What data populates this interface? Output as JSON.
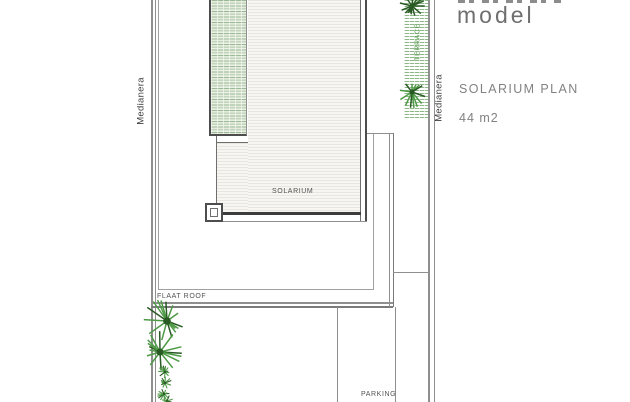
{
  "panel": {
    "model_label": "model",
    "plan_title": "SOLARIUM PLAN",
    "area_label": "44 m2"
  },
  "plan": {
    "labels": {
      "left_boundary": "Medianera",
      "right_boundary": "Medianera",
      "terrace": "TERRACE",
      "solarium": "SOLARIUM",
      "flat_roof": "FLAAT ROOF",
      "parking": "PARKING"
    },
    "colors": {
      "wall_dark": "#4d4d4d",
      "line_gray": "#8f8f8f",
      "thick_edge": "#3c3c3c",
      "plant_green": "#4e9a46",
      "plant_dark": "#2a5a24",
      "terrace_green": "#68a060",
      "label_text": "#545454",
      "panel_text": "#828282"
    }
  }
}
